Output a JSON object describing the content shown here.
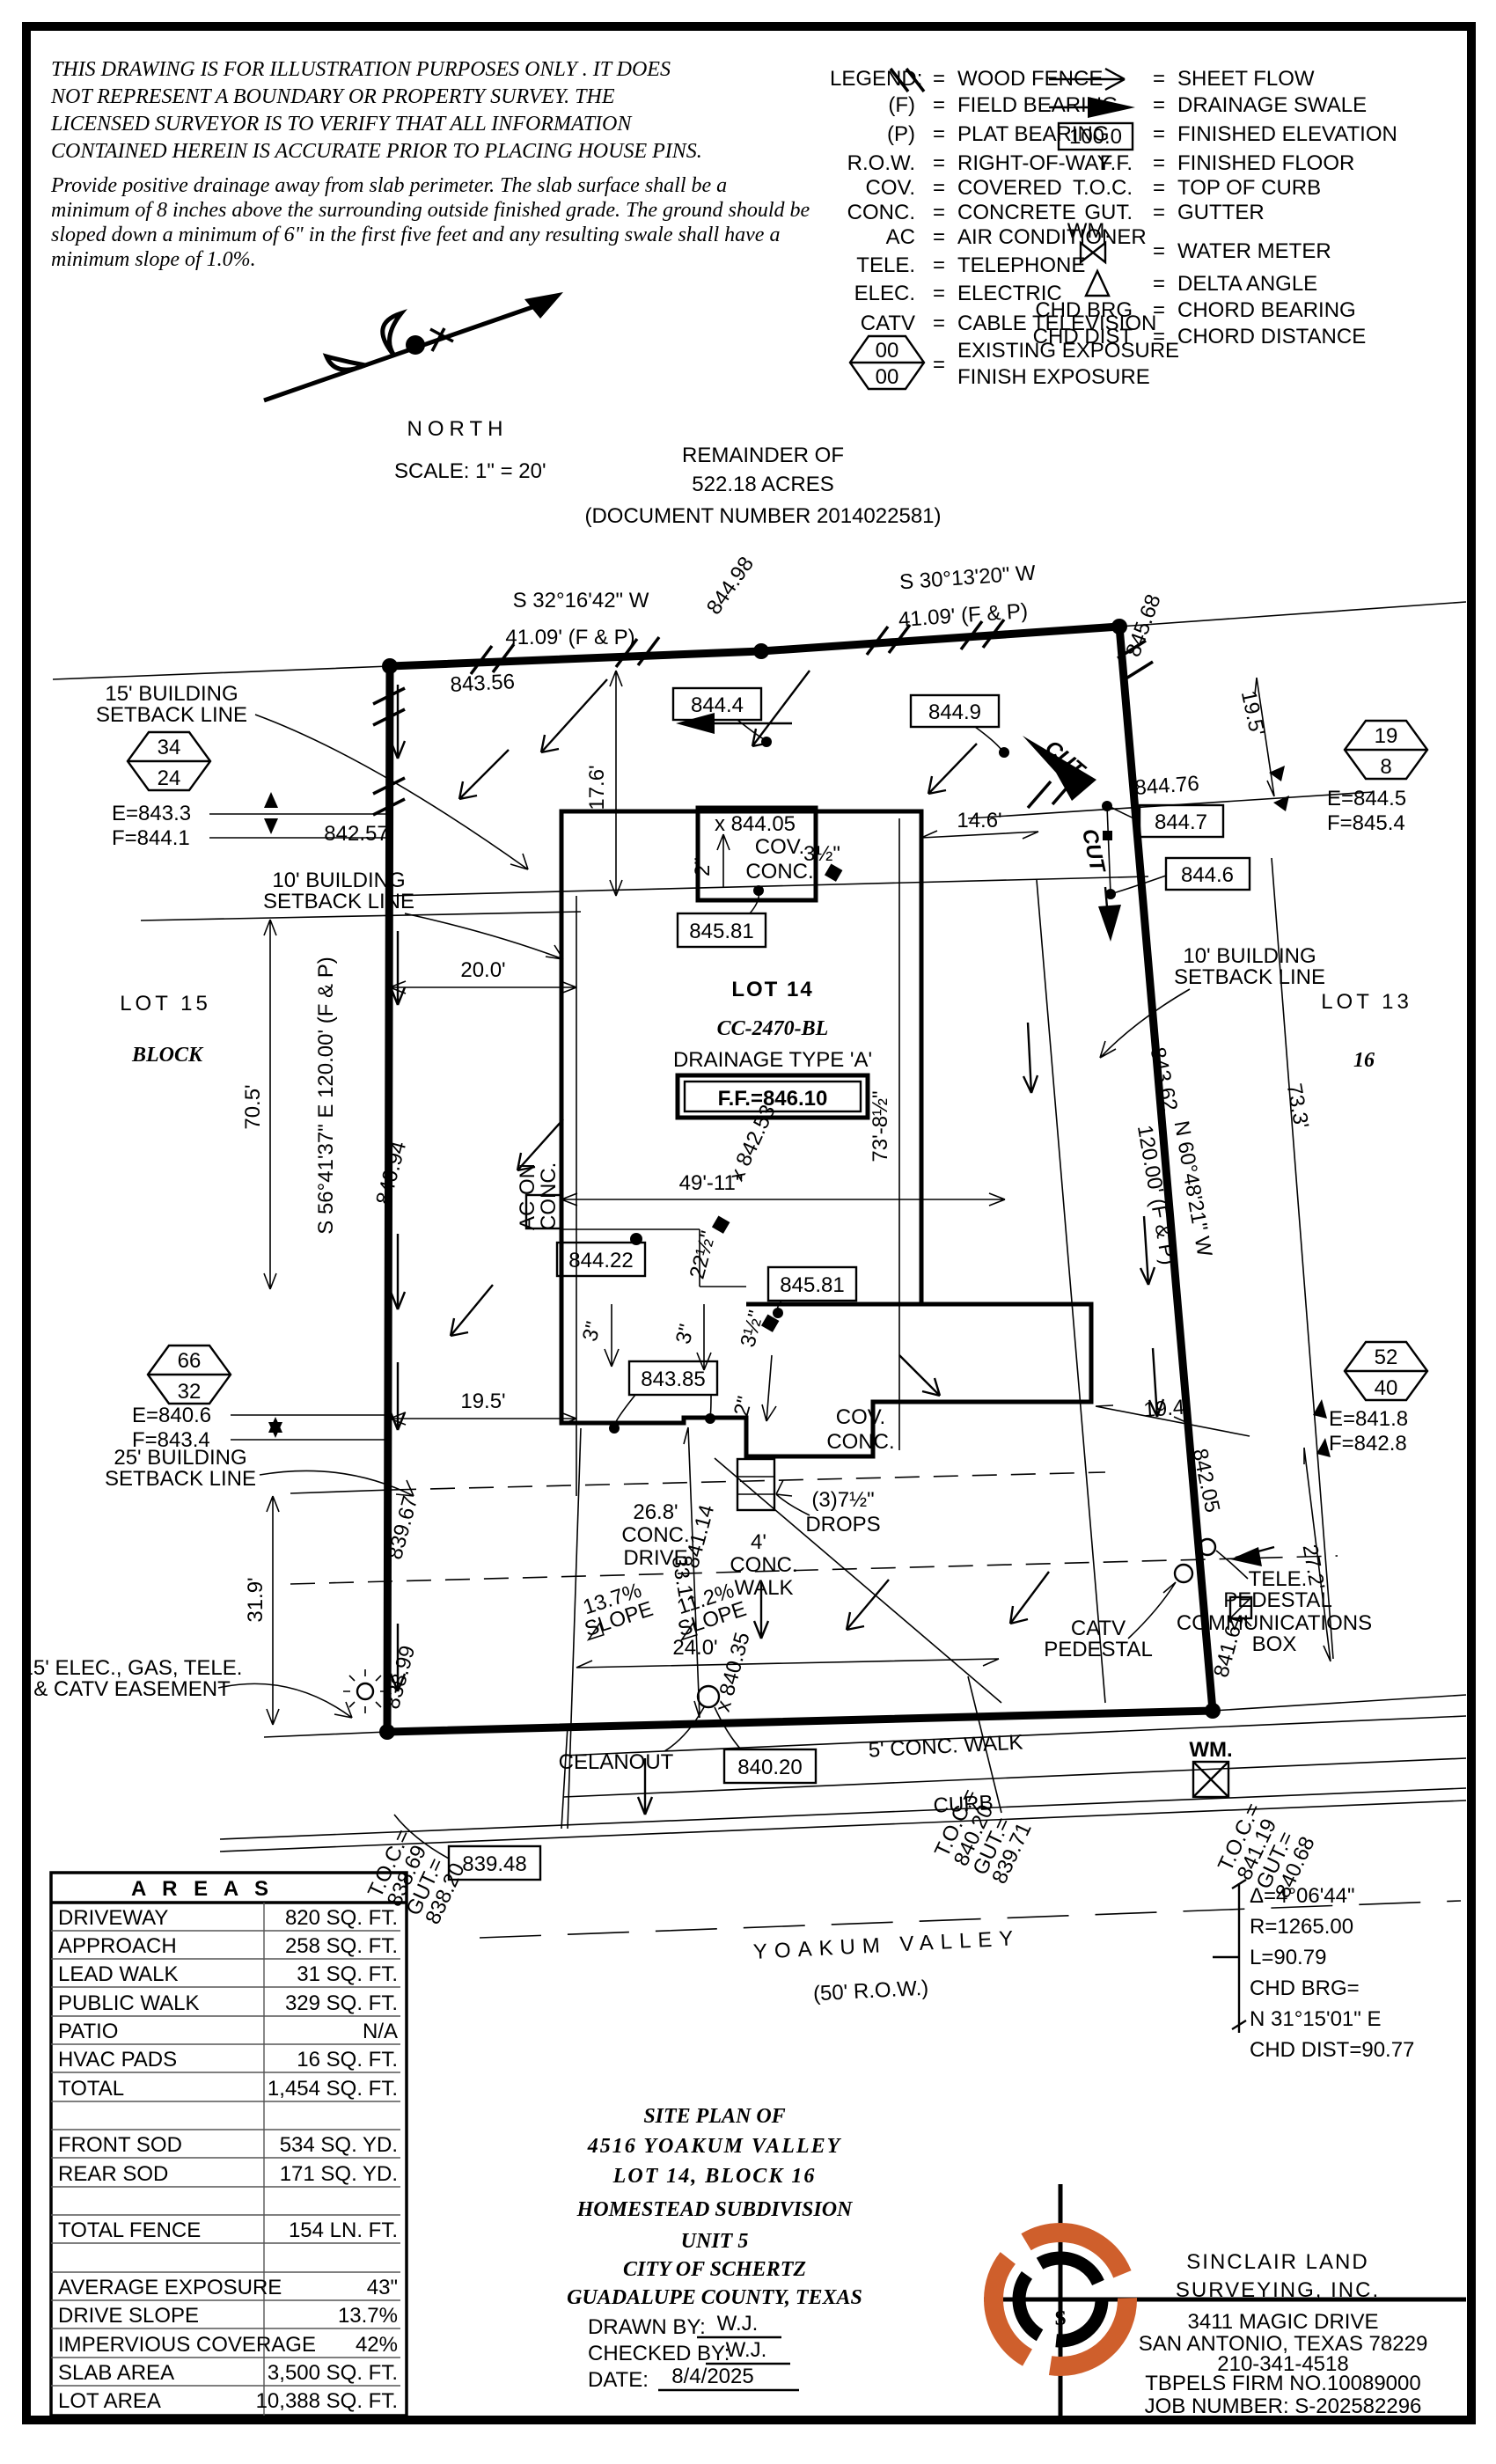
{
  "disclaimer": {
    "p1": [
      "THIS DRAWING IS FOR ILLUSTRATION PURPOSES ONLY . IT DOES",
      "NOT REPRESENT A BOUNDARY OR PROPERTY SURVEY. THE",
      "LICENSED SURVEYOR IS TO VERIFY THAT ALL INFORMATION",
      "CONTAINED HEREIN IS ACCURATE PRIOR TO PLACING HOUSE PINS."
    ],
    "p2": [
      "Provide positive drainage away from slab perimeter. The slab surface shall be a",
      "minimum of 8 inches above the surrounding outside finished grade. The ground should be",
      "sloped down a minimum of 6\" in the first five feet and any resulting swale shall have a",
      "minimum slope of 1.0%."
    ]
  },
  "legend": {
    "title": "LEGEND:",
    "eq": "=",
    "left": [
      {
        "sym": "",
        "label": "WOOD FENCE"
      },
      {
        "sym": "(F)",
        "label": "FIELD BEARING"
      },
      {
        "sym": "(P)",
        "label": "PLAT BEARING"
      },
      {
        "sym": "R.O.W.",
        "label": "RIGHT-OF-WAY"
      },
      {
        "sym": "COV.",
        "label": "COVERED"
      },
      {
        "sym": "CONC.",
        "label": "CONCRETE"
      },
      {
        "sym": "AC",
        "label": "AIR CONDITIONER"
      },
      {
        "sym": "TELE.",
        "label": "TELEPHONE"
      },
      {
        "sym": "ELEC.",
        "label": "ELECTRIC"
      },
      {
        "sym": "CATV",
        "label": "CABLE TELEVISION"
      }
    ],
    "right": [
      {
        "sym": "",
        "label": "SHEET FLOW"
      },
      {
        "sym": "",
        "label": "DRAINAGE SWALE"
      },
      {
        "sym": "100.0",
        "label": "FINISHED ELEVATION"
      },
      {
        "sym": "F.F.",
        "label": "FINISHED FLOOR"
      },
      {
        "sym": "T.O.C.",
        "label": "TOP OF CURB"
      },
      {
        "sym": "GUT.",
        "label": "GUTTER"
      },
      {
        "sym": "WM.",
        "label": "WATER METER"
      },
      {
        "sym": "",
        "label": "DELTA ANGLE"
      },
      {
        "sym": "CHD BRG",
        "label": "CHORD BEARING"
      },
      {
        "sym": "CHD DIST",
        "label": "CHORD DISTANCE"
      }
    ],
    "exposure": {
      "top": "00",
      "bottom": "00",
      "line1": "EXISTING EXPOSURE",
      "line2": "FINISH EXPOSURE"
    }
  },
  "north": {
    "label": "NORTH",
    "scale": "SCALE: 1\" = 20'"
  },
  "remainder": {
    "l1": "REMAINDER OF",
    "l2": "522.18 ACRES",
    "l3": "(DOCUMENT NUMBER 2014022581)"
  },
  "bearings": {
    "tl1": "S 32°16'42\" W",
    "tl2": "41.09' (F & P)",
    "tr1": "S 30°13'20\" W",
    "tr2": "41.09' (F & P)",
    "left": "S 56°41'37\" E 120.00' (F & P)",
    "right1": "N 60°48'21\" W",
    "right2": "120.00' (F & P)"
  },
  "markers": {
    "h1": {
      "top": "34",
      "bottom": "24",
      "e": "E=843.3",
      "f": "F=844.1"
    },
    "h2": {
      "top": "19",
      "bottom": "8",
      "e": "E=844.5",
      "f": "F=845.4"
    },
    "h3": {
      "top": "66",
      "bottom": "32",
      "e": "E=840.6",
      "f": "F=843.4"
    },
    "h4": {
      "top": "52",
      "bottom": "40",
      "e": "E=841.8",
      "f": "F=842.8"
    }
  },
  "lots": {
    "lot15": "LOT 15",
    "block": "BLOCK",
    "lot13": "LOT 13",
    "block16": "16",
    "lot14": "LOT 14",
    "cc": "CC-2470-BL",
    "drainage": "DRAINAGE TYPE 'A'",
    "ff": "F.F.=846.10"
  },
  "setbacks": {
    "s15a": "15' BUILDING",
    "s15b": "SETBACK LINE",
    "s10la": "10' BUILDING",
    "s10lb": "SETBACK LINE",
    "s10ra": "10' BUILDING",
    "s10rb": "SETBACK LINE",
    "s25a": "25' BUILDING",
    "s25b": "SETBACK LINE",
    "easea": "15' ELEC., GAS, TELE.",
    "easeb": "& CATV EASEMENT"
  },
  "dims": {
    "d176": "17.6'",
    "d200": "20.0'",
    "d705": "70.5'",
    "d146": "14.6'",
    "d195r": "19.5'",
    "d195l": "19.5'",
    "d194": "19.4'",
    "d319": "31.9'",
    "d272": "27.2'",
    "d240": "24.0'",
    "d331": "33.1'",
    "d733": "73.3'",
    "d4911": "49'-11\"",
    "d7385": "73'-8½\"",
    "drv1": "26.8'",
    "drv2": "CONC.",
    "drv3": "DRIVE",
    "sl1a": "13.7%",
    "sl1b": "SLOPE",
    "sl2a": "11.2%",
    "sl2b": "SLOPE"
  },
  "elev": {
    "e84356": "843.56",
    "e84498": "844.98",
    "e84568": "845.68",
    "e8444": "844.4",
    "e8449": "844.9",
    "e84476": "844.76",
    "e8447": "844.7",
    "e8446": "844.6",
    "e84257": "842.57",
    "e84405": "x 844.05",
    "e84581a": "845.81",
    "e84581b": "845.81",
    "e84422": "844.22",
    "e84385": "843.85",
    "e84253": "x 842.53",
    "e84362": "843.62",
    "e84094": "840.94",
    "e83967": "839.67",
    "e83899": "838.99",
    "e84205": "842.05",
    "e84161": "841.61",
    "e84114": "841.14",
    "e84035": "x 840.35",
    "e83948": "839.48",
    "e84020": "840.20",
    "cut1": "CUT",
    "cut2": "CUT"
  },
  "house": {
    "cov1a": "COV.",
    "cov1b": "CONC.",
    "cov2a": "COV.",
    "cov2b": "CONC.",
    "ac1": "AC ON",
    "ac2": "CONC.",
    "in2a": "2\"",
    "in2b": "2\"",
    "in3a": "3\"",
    "in3b": "3\"",
    "in35a": "3½\"",
    "in35b": "3½\"",
    "in225": "22½\"",
    "drops1": "(3)7½\"",
    "drops2": "DROPS",
    "walk4a": "4'",
    "walk4b": "CONC.",
    "walk4c": "WALK",
    "cleanout": "CELANOUT",
    "walk5": "5' CONC. WALK",
    "curb": "CURB"
  },
  "street": {
    "name": "YOAKUM VALLEY",
    "row": "(50' R.O.W.)"
  },
  "toc": {
    "wm": "WM.",
    "left": [
      "T.O.C.=",
      "838.69",
      "GUT.=",
      "838.20"
    ],
    "mid": [
      "T.O.C.=",
      "840.20",
      "GUT.=",
      "839.71"
    ],
    "right": [
      "T.O.C.=",
      "841.19",
      "GUT.=",
      "840.68"
    ]
  },
  "utilities": {
    "tele1": "TELE.",
    "tele2": "PEDESTAL",
    "comm1": "COMMUNICATIONS",
    "comm2": "BOX",
    "catv1": "CATV",
    "catv2": "PEDESTAL"
  },
  "curve": {
    "l1": "Δ=4°06'44\"",
    "l2": "R=1265.00",
    "l3": "L=90.79",
    "l4": "CHD BRG=",
    "l5": "N 31°15'01\" E",
    "l6": "CHD DIST=90.77"
  },
  "areas": {
    "title": "A R E A S",
    "rows": [
      {
        "label": "DRIVEWAY",
        "value": "820 SQ. FT."
      },
      {
        "label": "APPROACH",
        "value": "258 SQ. FT."
      },
      {
        "label": "LEAD WALK",
        "value": "31 SQ. FT."
      },
      {
        "label": "PUBLIC WALK",
        "value": "329 SQ. FT."
      },
      {
        "label": "PATIO",
        "value": "N/A"
      },
      {
        "label": "HVAC PADS",
        "value": "16 SQ. FT."
      },
      {
        "label": "TOTAL",
        "value": "1,454 SQ. FT."
      },
      {
        "label": "",
        "value": ""
      },
      {
        "label": "FRONT SOD",
        "value": "534 SQ. YD."
      },
      {
        "label": "REAR SOD",
        "value": "171 SQ. YD."
      },
      {
        "label": "",
        "value": ""
      },
      {
        "label": "TOTAL FENCE",
        "value": "154 LN. FT."
      },
      {
        "label": "",
        "value": ""
      },
      {
        "label": "AVERAGE EXPOSURE",
        "value": "43\""
      },
      {
        "label": "DRIVE SLOPE",
        "value": "13.7%"
      },
      {
        "label": "IMPERVIOUS COVERAGE",
        "value": "42%"
      },
      {
        "label": "SLAB AREA",
        "value": "3,500 SQ. FT."
      },
      {
        "label": "LOT AREA",
        "value": "10,388 SQ. FT."
      }
    ]
  },
  "titleblock": {
    "l1": "SITE PLAN OF",
    "l2": "4516 YOAKUM VALLEY",
    "l3": "LOT 14, BLOCK 16",
    "l4": "HOMESTEAD SUBDIVISION",
    "l5": "UNIT 5",
    "l6": "CITY OF SCHERTZ",
    "l7": "GUADALUPE COUNTY, TEXAS",
    "drawn_label": "DRAWN BY:",
    "drawn": "W.J.",
    "checked_label": "CHECKED BY:",
    "checked": "W.J.",
    "date_label": "DATE:",
    "date": "8/4/2025"
  },
  "company": {
    "logo_s": "S",
    "name1": "SINCLAIR LAND",
    "name2": "SURVEYING, INC.",
    "addr1": "3411 MAGIC DRIVE",
    "addr2": "SAN ANTONIO, TEXAS 78229",
    "phone": "210-341-4518",
    "firm": "TBPELS FIRM NO.10089000",
    "job": "JOB NUMBER: S-202582296"
  },
  "colors": {
    "accent": "#cf5f2c",
    "ink": "#000000"
  }
}
